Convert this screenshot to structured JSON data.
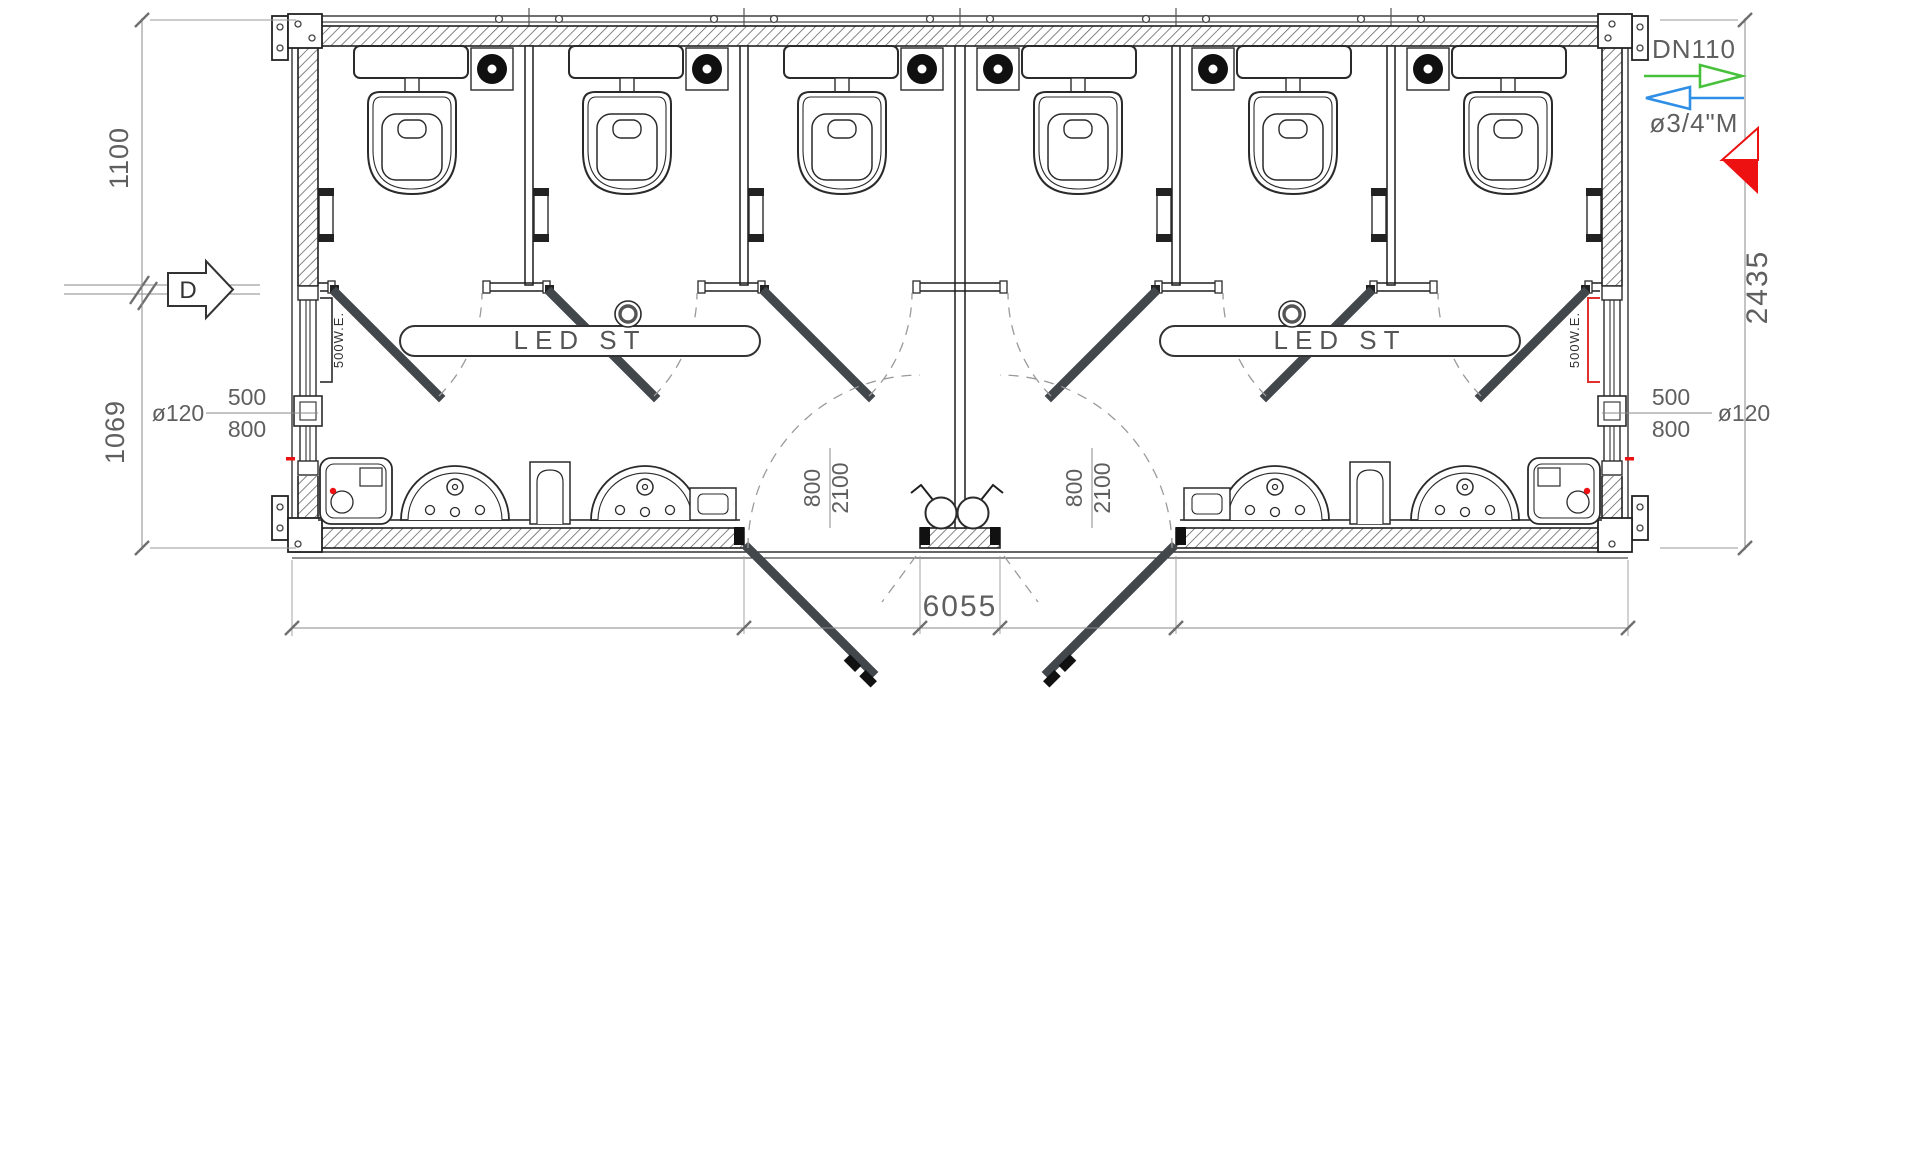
{
  "dimensions": {
    "left_upper": "1100",
    "left_lower": "1069",
    "right_overall": "2435",
    "bottom_overall": "6055"
  },
  "door_label": {
    "width": "800",
    "height": "2100"
  },
  "window_label": {
    "vent_dia": "ø120",
    "width": "500",
    "height": "800"
  },
  "labels": {
    "led_strip": "LED ST",
    "heater": "500W.E.",
    "section_marker": "D"
  },
  "plumbing": {
    "drain": "DN110",
    "supply": "ø3/4\"M"
  },
  "colors": {
    "drain_green": "#47c13b",
    "supply_blue": "#2f8fe6",
    "marker_red": "#ee1111",
    "heater_red": "#e03030",
    "line_dark": "#1f1f1f"
  }
}
